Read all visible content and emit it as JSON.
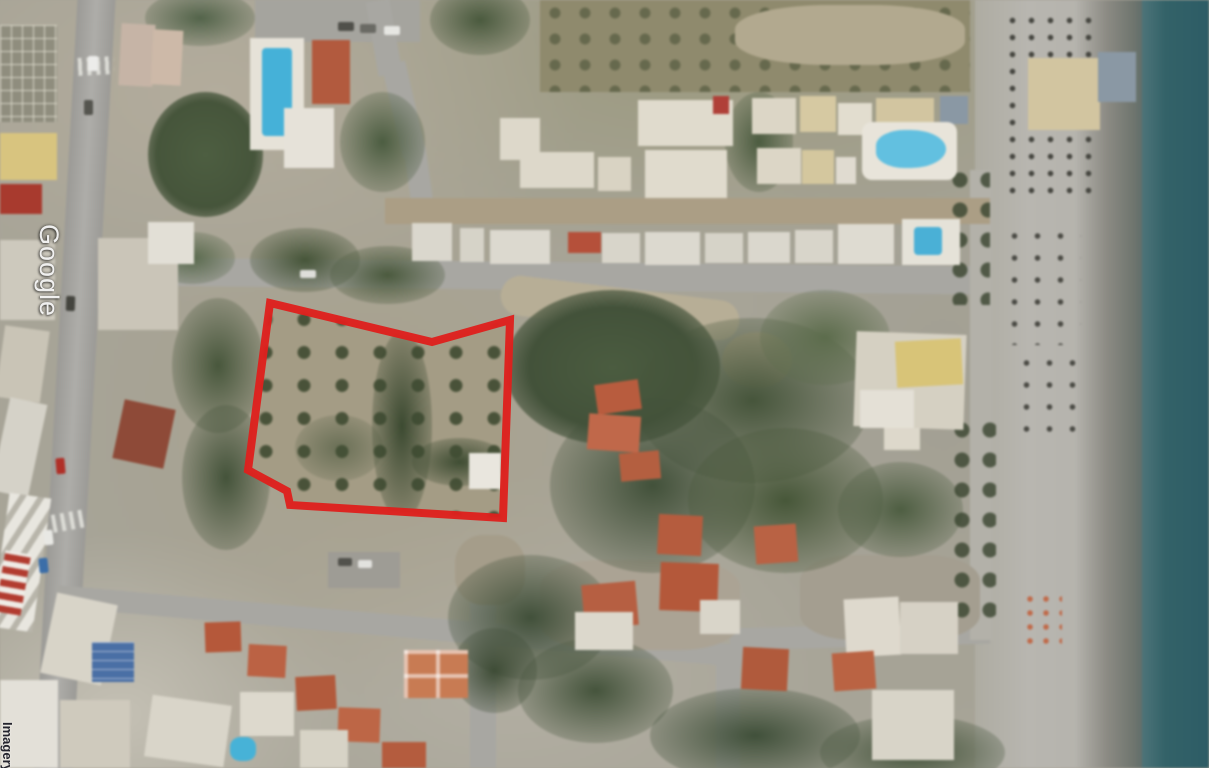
{
  "watermark": {
    "brand": "Google",
    "attribution": "Imagery"
  },
  "overlay": {
    "label": "plot-boundary",
    "stroke_color": "#de201d",
    "stroke_width": 8,
    "points": [
      [
        270,
        303
      ],
      [
        432,
        342
      ],
      [
        510,
        320
      ],
      [
        503,
        518
      ],
      [
        290,
        505
      ],
      [
        287,
        491
      ],
      [
        248,
        470
      ]
    ]
  },
  "scene": {
    "type": "satellite-aerial",
    "description": "coastal village with olive-grove plot outlined in red, beach and sea on the right",
    "sea_color": "#2e5f68",
    "sand_color": "#b5b3ac",
    "pool_color": "#45b1d8",
    "roof_color": "#b25a3e"
  }
}
